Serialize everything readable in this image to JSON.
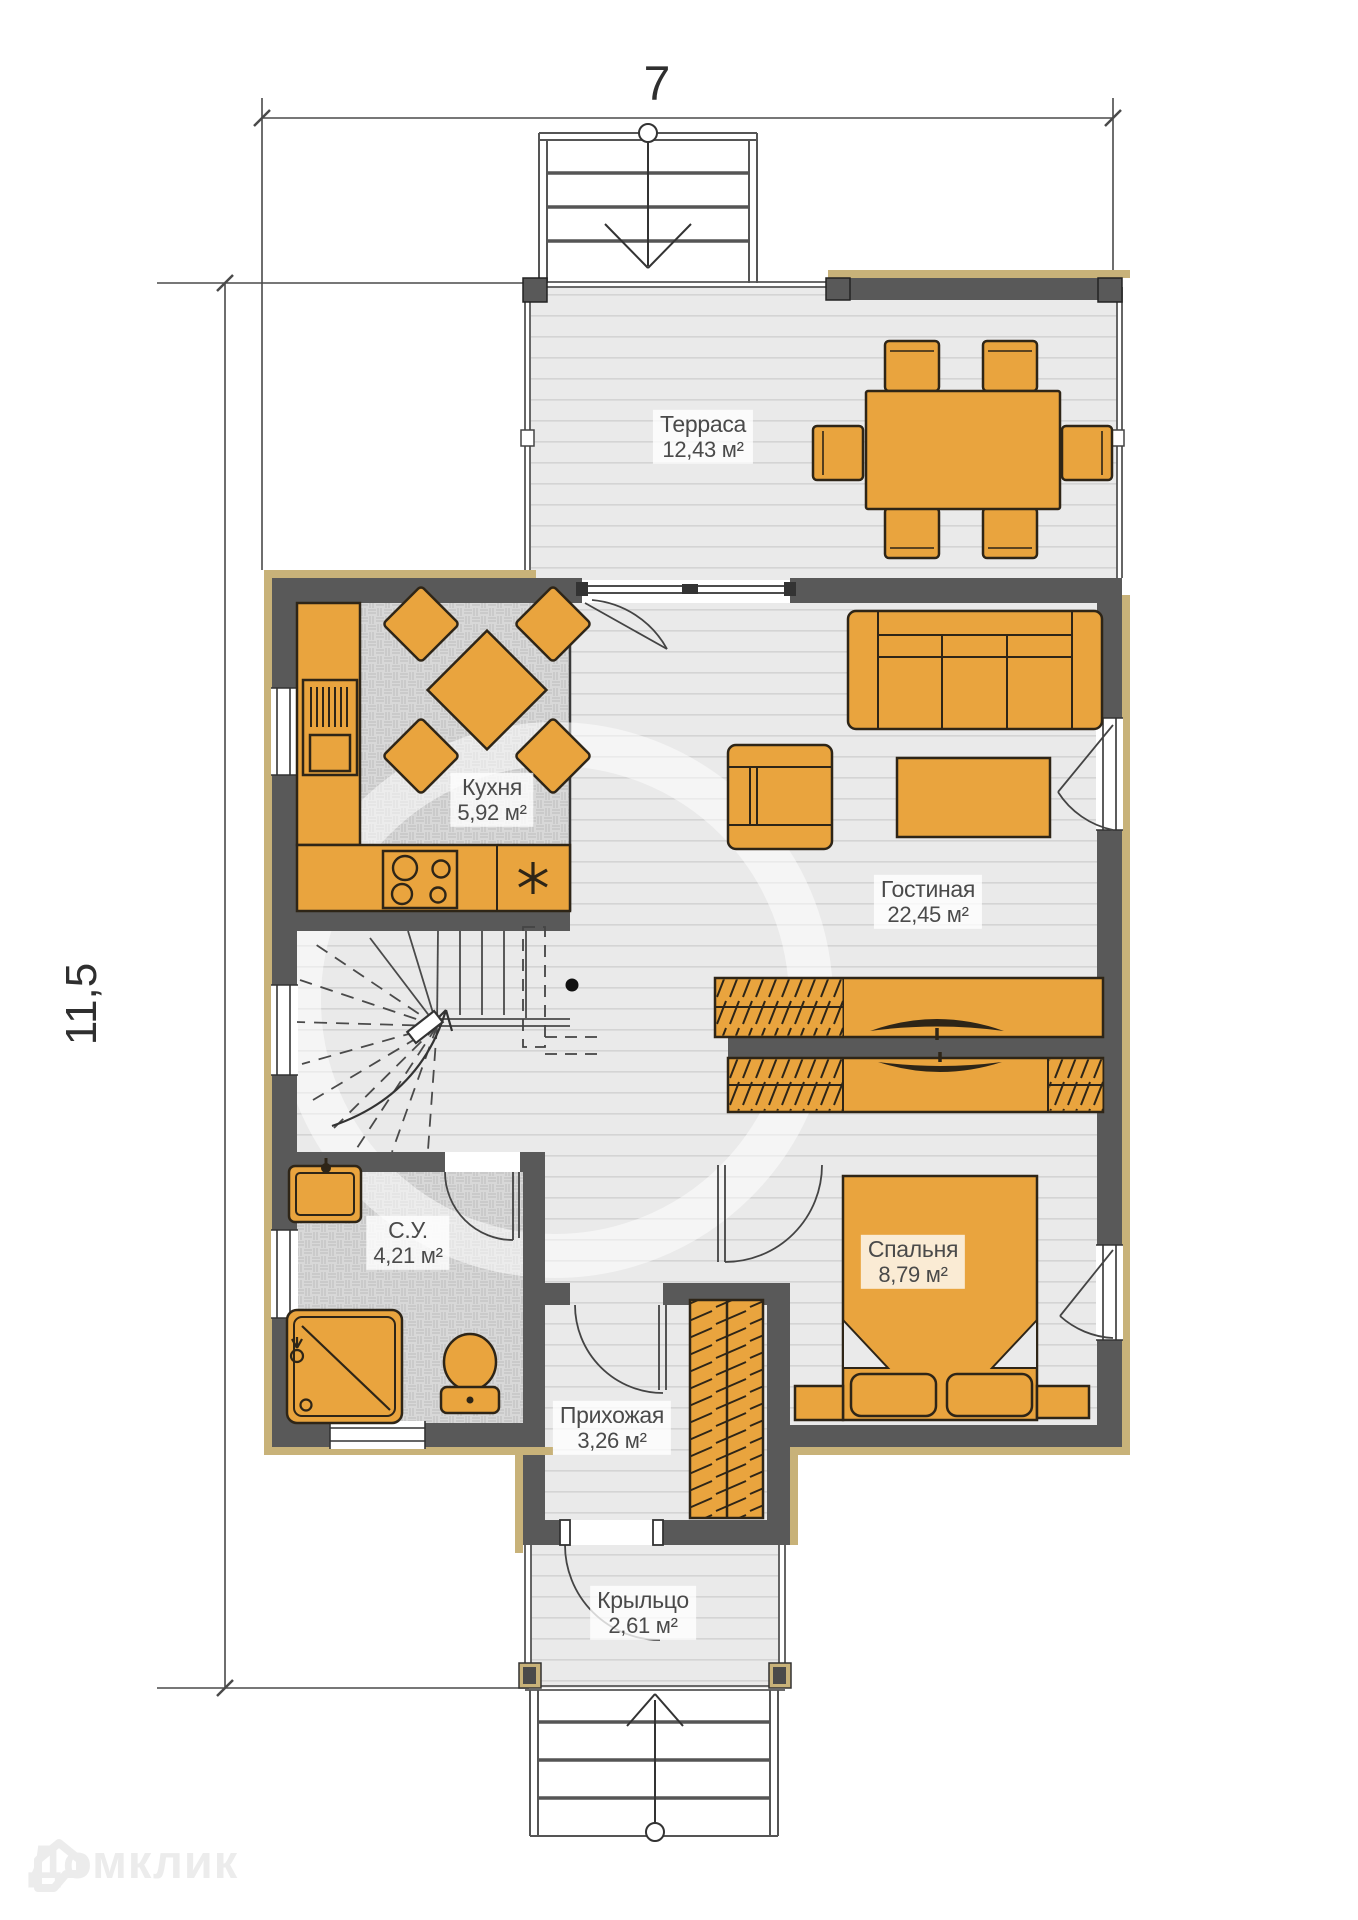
{
  "dimensions": {
    "width_label": "7",
    "height_label": "11,5"
  },
  "rooms": {
    "terrace": {
      "name": "Терраса",
      "area": "12,43 м²"
    },
    "kitchen": {
      "name": "Кухня",
      "area": "5,92 м²"
    },
    "living": {
      "name": "Гостиная",
      "area": "22,45 м²"
    },
    "bathroom": {
      "name": "С.У.",
      "area": "4,21 м²"
    },
    "bedroom": {
      "name": "Спальня",
      "area": "8,79 м²"
    },
    "hallway": {
      "name": "Прихожая",
      "area": "3,26 м²"
    },
    "porch": {
      "name": "Крыльцо",
      "area": "2,61 м²"
    }
  },
  "watermark": {
    "brand": "Домклик"
  },
  "colors": {
    "furniture": "#E9A43E",
    "walls": "#595959",
    "trim": "#C8B279",
    "floor": "#EAEAEA",
    "floor_lines": "#D4D4D4",
    "parquet": "#D8D8D8",
    "outline": "#2E2517",
    "label_text": "#4A4A4A"
  }
}
